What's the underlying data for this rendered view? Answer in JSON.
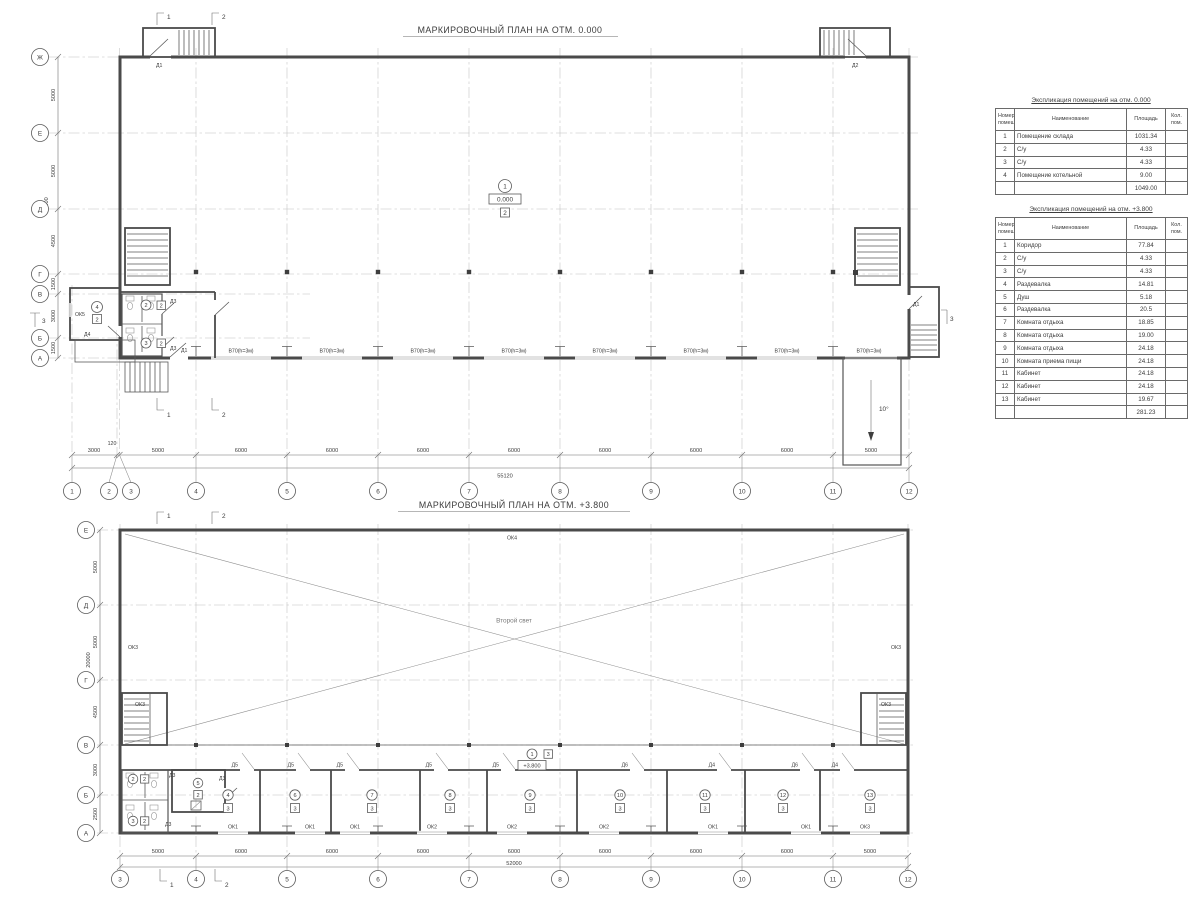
{
  "plan1": {
    "title": "МАРКИРОВОЧНЫЙ ПЛАН НА ОТМ. 0.000",
    "grid": {
      "cols": [
        "1",
        "2",
        "3",
        "4",
        "5",
        "6",
        "7",
        "8",
        "9",
        "10",
        "11",
        "12"
      ],
      "col_dims": [
        "3000",
        "120",
        "5000",
        "6000",
        "6000",
        "6000",
        "6000",
        "6000",
        "6000",
        "6000",
        "5000"
      ],
      "total_width": "55120",
      "rows": [
        "Ж",
        "Е",
        "Д",
        "Г",
        "В",
        "Б",
        "А"
      ],
      "row_dims": [
        "5000",
        "5000",
        "4500",
        "1500",
        "3000",
        "1500"
      ],
      "total_height": "20000"
    },
    "rooms": {
      "hall": {
        "num": "1",
        "elev": "0.000",
        "floor": "2"
      },
      "wc1": {
        "num": "2",
        "floor": "2"
      },
      "wc2": {
        "num": "3",
        "floor": "2"
      },
      "boiler": {
        "num": "4",
        "floor": "2"
      }
    },
    "doors": {
      "d1": "Д1",
      "d2": "Д2",
      "d3": "Д3",
      "d4": "Д4"
    },
    "windows": {
      "ok5": "ОК5"
    },
    "gate_label": "В70(h=3м)",
    "ramp_angle": "10°",
    "sections": {
      "s1": "1",
      "s2": "2",
      "s3": "3"
    }
  },
  "plan2": {
    "title": "МАРКИРОВОЧНЫЙ ПЛАН НА ОТМ. +3.800",
    "grid": {
      "cols": [
        "3",
        "4",
        "5",
        "6",
        "7",
        "8",
        "9",
        "10",
        "11",
        "12"
      ],
      "col_dims": [
        "5000",
        "6000",
        "6000",
        "6000",
        "6000",
        "6000",
        "6000",
        "6000",
        "5000"
      ],
      "total_width": "52000",
      "rows": [
        "Е",
        "Д",
        "Г",
        "В",
        "Б",
        "А"
      ],
      "row_dims": [
        "5000",
        "5000",
        "4500",
        "3000",
        "2500"
      ],
      "total_height": "20000"
    },
    "void_label": "Второй свет",
    "corridor": {
      "num": "1",
      "floor": "3",
      "elev": "+3.800"
    },
    "rooms": {
      "wc1": {
        "num": "2",
        "floor": "2"
      },
      "wc2": {
        "num": "3",
        "floor": "2"
      },
      "shower": {
        "num": "5",
        "floor": "2"
      },
      "row": [
        {
          "num": "4",
          "floor": "3",
          "window": "ОК1",
          "door": "Д5"
        },
        {
          "num": "6",
          "floor": "3",
          "window": "ОК1",
          "door": "Д5"
        },
        {
          "num": "7",
          "floor": "3",
          "window": "ОК1",
          "door": "Д5"
        },
        {
          "num": "8",
          "floor": "3",
          "window": "ОК2",
          "door": "Д5"
        },
        {
          "num": "9",
          "floor": "3",
          "window": "ОК2",
          "door": "Д5"
        },
        {
          "num": "10",
          "floor": "3",
          "window": "ОК2",
          "door": "Д6"
        },
        {
          "num": "11",
          "floor": "3",
          "window": "ОК1",
          "door": "Д4"
        },
        {
          "num": "12",
          "floor": "3",
          "window": "ОК1",
          "door": "Д6"
        },
        {
          "num": "13",
          "floor": "3",
          "window": "ОК3",
          "door": "Д4"
        }
      ]
    },
    "doors": {
      "d3": "Д3"
    },
    "windows": {
      "ok3": "ОК3",
      "ok4": "ОК4"
    },
    "sections": {
      "s1": "1",
      "s2": "2"
    }
  },
  "table1": {
    "title": "Экспликация помещений на отм. 0.000",
    "headers": [
      "Номер помещ.",
      "Наименование",
      "Площадь",
      "Кол. пом."
    ],
    "rows": [
      [
        "1",
        "Помещение склада",
        "1031.34",
        ""
      ],
      [
        "2",
        "С/у",
        "4.33",
        ""
      ],
      [
        "3",
        "С/у",
        "4.33",
        ""
      ],
      [
        "4",
        "Помещение котельной",
        "9.00",
        ""
      ]
    ],
    "total_row": [
      "",
      "",
      "1049.00",
      ""
    ]
  },
  "table2": {
    "title": "Экспликация помещений на отм. +3.800",
    "headers": [
      "Номер помещ.",
      "Наименование",
      "Площадь",
      "Кол. пом."
    ],
    "rows": [
      [
        "1",
        "Коридор",
        "77.84",
        ""
      ],
      [
        "2",
        "С/у",
        "4.33",
        ""
      ],
      [
        "3",
        "С/у",
        "4.33",
        ""
      ],
      [
        "4",
        "Раздевалка",
        "14.81",
        ""
      ],
      [
        "5",
        "Душ",
        "5.18",
        ""
      ],
      [
        "6",
        "Раздевалка",
        "20.5",
        ""
      ],
      [
        "7",
        "Комната отдыха",
        "18.85",
        ""
      ],
      [
        "8",
        "Комната отдыха",
        "19.00",
        ""
      ],
      [
        "9",
        "Комната отдыха",
        "24.18",
        ""
      ],
      [
        "10",
        "Комната приема пищи",
        "24.18",
        ""
      ],
      [
        "11",
        "Кабинет",
        "24.18",
        ""
      ],
      [
        "12",
        "Кабинет",
        "24.18",
        ""
      ],
      [
        "13",
        "Кабинет",
        "19.67",
        ""
      ]
    ],
    "total_row": [
      "",
      "",
      "281.23",
      ""
    ]
  }
}
